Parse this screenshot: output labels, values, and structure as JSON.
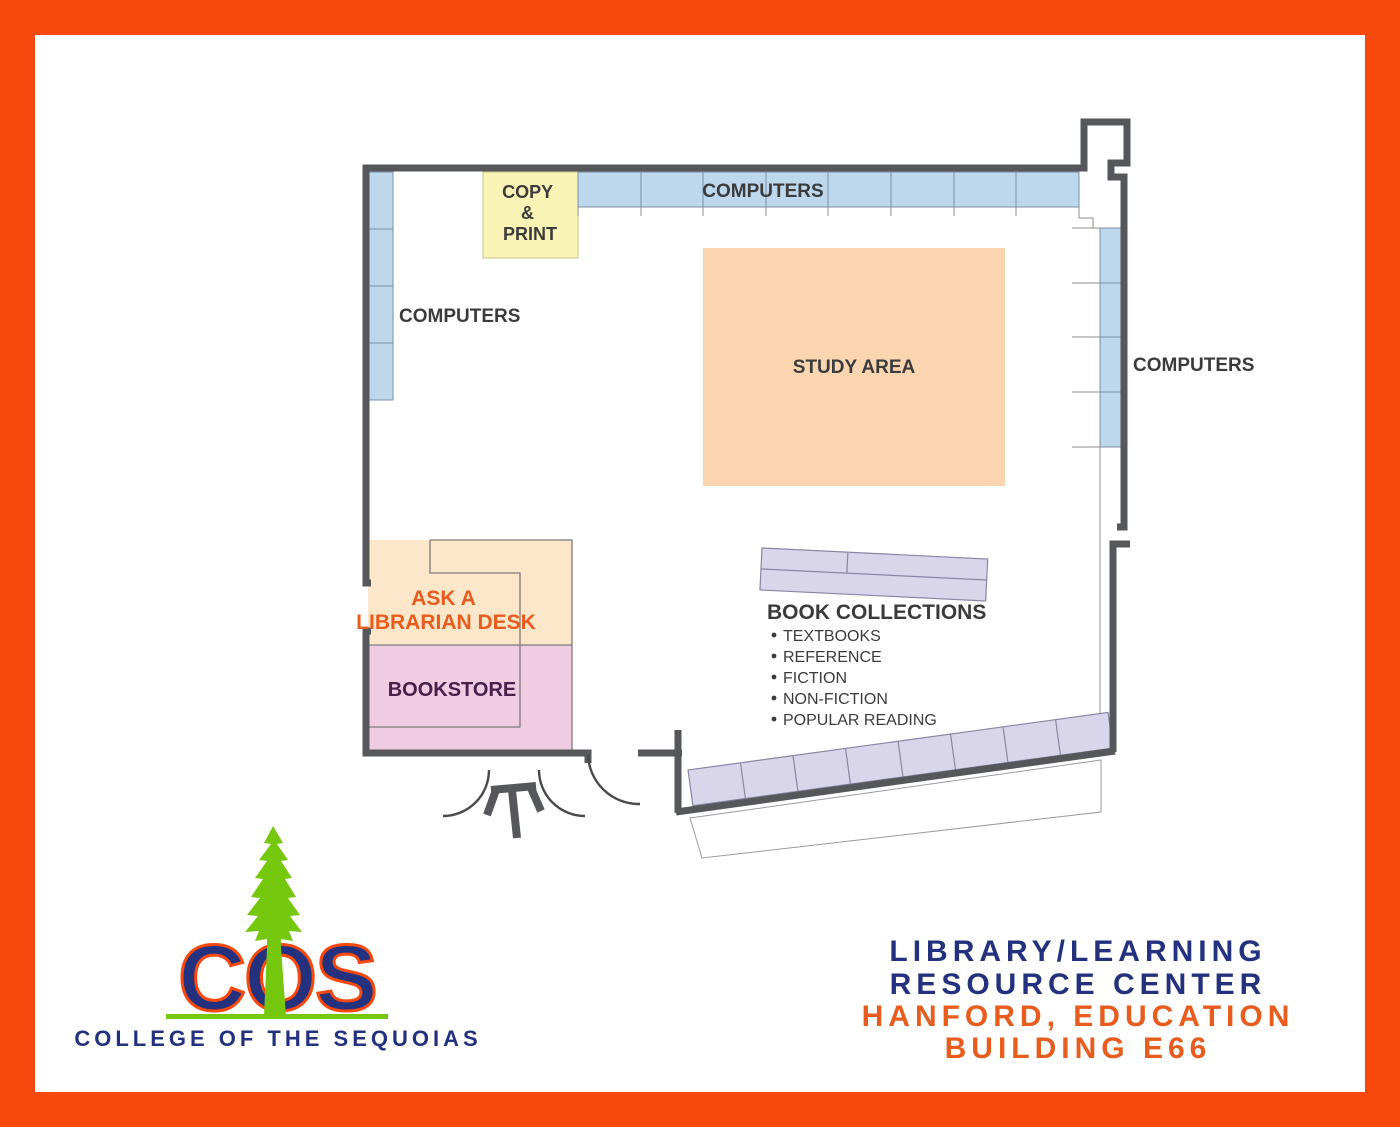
{
  "colors": {
    "frame_orange": "#F8490C",
    "wall_gray": "#56575A",
    "computer_fill": "#BDD8EC",
    "computer_stroke": "#7C8FA6",
    "study_fill": "#FBD5AF",
    "desk_fill": "#FCE7CB",
    "bookstore_fill": "#F0CCE3",
    "bookstore_text": "#46214B",
    "copy_print_fill": "#F9F4B5",
    "shelf_fill": "#D9D6EC",
    "shelf_stroke": "#8886A3",
    "label_gray": "#3B3B3B",
    "navy": "#23317F",
    "accent_orange": "#E85C1E",
    "tree_green": "#76C80E"
  },
  "labels": {
    "computers_left": "COMPUTERS",
    "computers_top": "COMPUTERS",
    "computers_right": "COMPUTERS",
    "study_area": "STUDY AREA",
    "copy_print": [
      "COPY",
      "&",
      "PRINT"
    ],
    "ask_librarian": [
      "ASK A",
      "LIBRARIAN DESK"
    ],
    "bookstore": "BOOKSTORE"
  },
  "book_collections": {
    "title": "BOOK COLLECTIONS",
    "items": [
      "TEXTBOOKS",
      "REFERENCE",
      "FICTION",
      "NON-FICTION",
      "POPULAR READING"
    ]
  },
  "branding": {
    "acronym": "COS",
    "college_name": "COLLEGE OF THE SEQUOIAS",
    "caption_line1": "LIBRARY/LEARNING",
    "caption_line2": "RESOURCE CENTER",
    "caption_line3": "HANFORD, EDUCATION",
    "caption_line4": "BUILDING E66"
  }
}
